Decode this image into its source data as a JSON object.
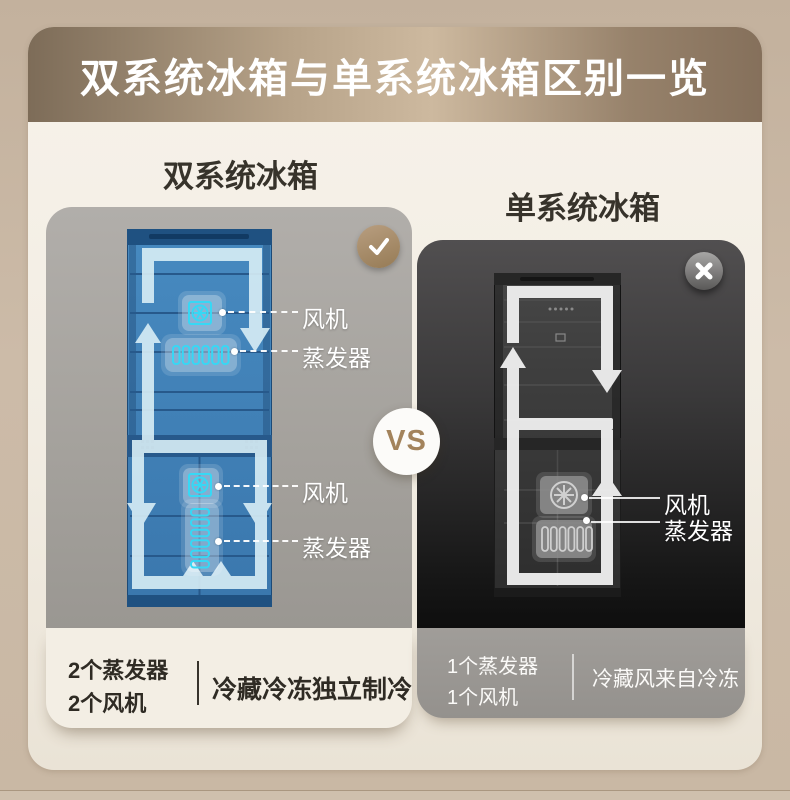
{
  "banner": {
    "title": "双系统冰箱与单系统冰箱区别一览"
  },
  "dual_system": {
    "heading": "双系统冰箱",
    "badge_icon": "check",
    "callouts": {
      "fridge_fan": "风机",
      "fridge_evaporator": "蒸发器",
      "freezer_fan": "风机",
      "freezer_evaporator": "蒸发器"
    },
    "footer": {
      "count_line1": "2个蒸发器",
      "count_line2": "2个风机",
      "description": "冷藏冷冻独立制冷"
    }
  },
  "single_system": {
    "heading": "单系统冰箱",
    "badge_icon": "cross",
    "callouts": {
      "fan": "风机",
      "evaporator": "蒸发器"
    },
    "footer": {
      "count_line1": "1个蒸发器",
      "count_line2": "1个风机",
      "description": "冷藏风来自冷冻"
    }
  },
  "vs_badge": {
    "label": "VS"
  },
  "colors": {
    "banner_gradient": [
      "#7d6c58",
      "#cdb99f",
      "#85705b"
    ],
    "page_background": "#c8b7a3",
    "card_background": "#f2ede3",
    "dual_panel_background": "#a7a4a0",
    "single_panel_background": "#333233",
    "fridge_blue": "#4383b8",
    "icon_cyan": "#36d8f5",
    "arrow_pale": "#d8eef6",
    "vs_text": "#a3835c",
    "check_badge_gold": "#a98e6d"
  }
}
